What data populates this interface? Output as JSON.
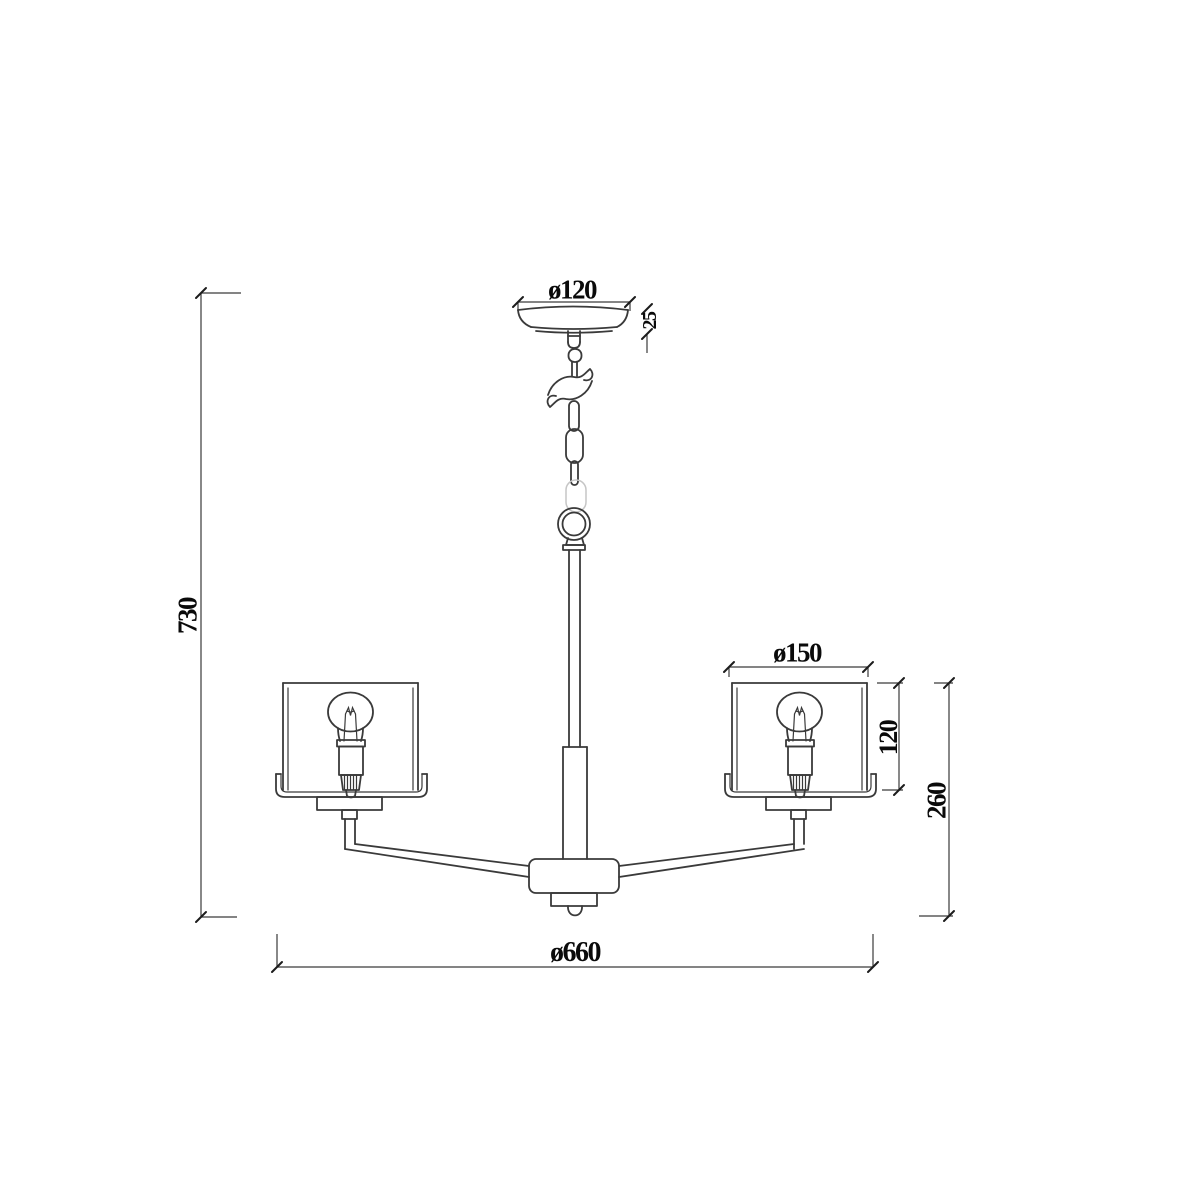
{
  "drawing": {
    "background_color": "#ffffff",
    "line_color": "#3a3a3a",
    "text_color": "#0a0a0a",
    "labels": {
      "canopy_diameter": "ø120",
      "canopy_height": "25",
      "overall_height": "730",
      "shade_diameter": "ø150",
      "shade_height": "120",
      "body_drop_height": "260",
      "fixture_diameter": "ø660"
    }
  }
}
